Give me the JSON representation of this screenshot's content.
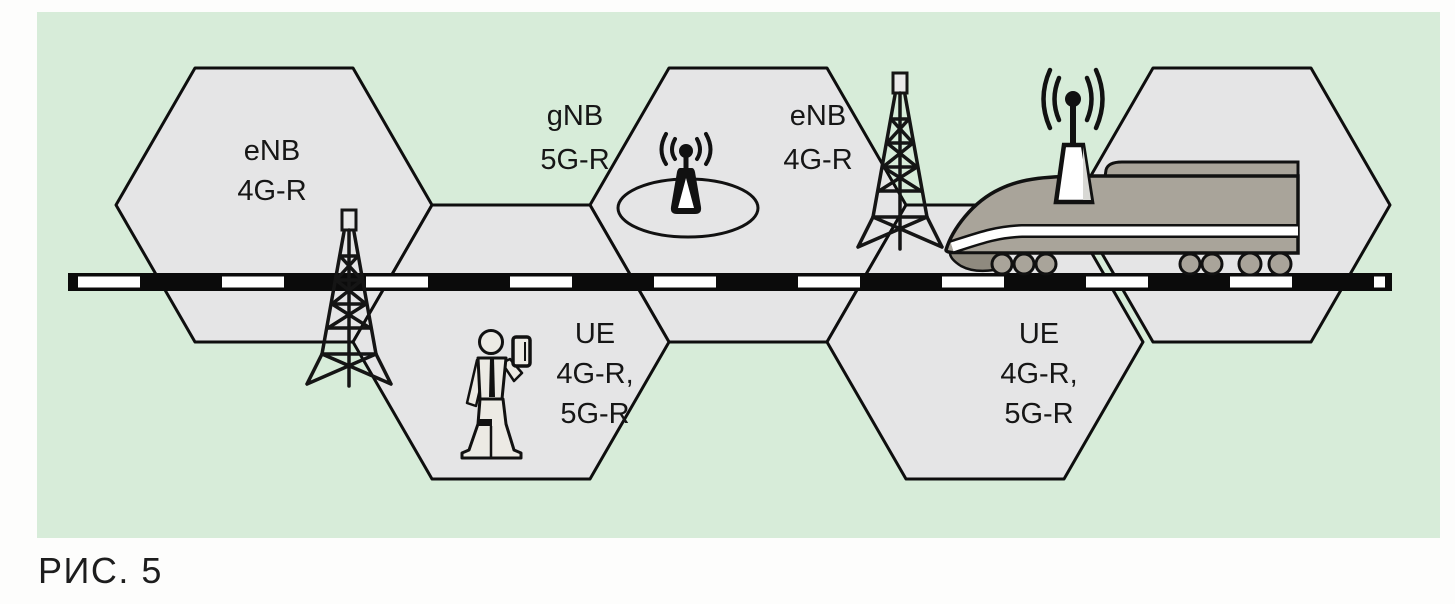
{
  "figure": {
    "caption": "РИС. 5"
  },
  "labels": {
    "enb_left": {
      "line1": "eNB",
      "line2": "4G-R"
    },
    "gnb_small_cell": {
      "line1": "gNB",
      "line2": "5G-R"
    },
    "enb_right": {
      "line1": "eNB",
      "line2": "4G-R"
    },
    "ue_left": {
      "line1": "UE",
      "line2": "4G-R,",
      "line3": "5G-R"
    },
    "ue_right": {
      "line1": "UE",
      "line2": "4G-R,",
      "line3": "5G-R"
    }
  },
  "colors": {
    "photo_background": "#d7ecd9",
    "cell_fill": "#e5e5e6",
    "outline": "#111111",
    "train_body": "#a9a49a",
    "train_skirt": "#8f8a7f",
    "track_black": "#0b0b0b",
    "track_white": "#ffffff",
    "person_fill": "#eceae4"
  }
}
